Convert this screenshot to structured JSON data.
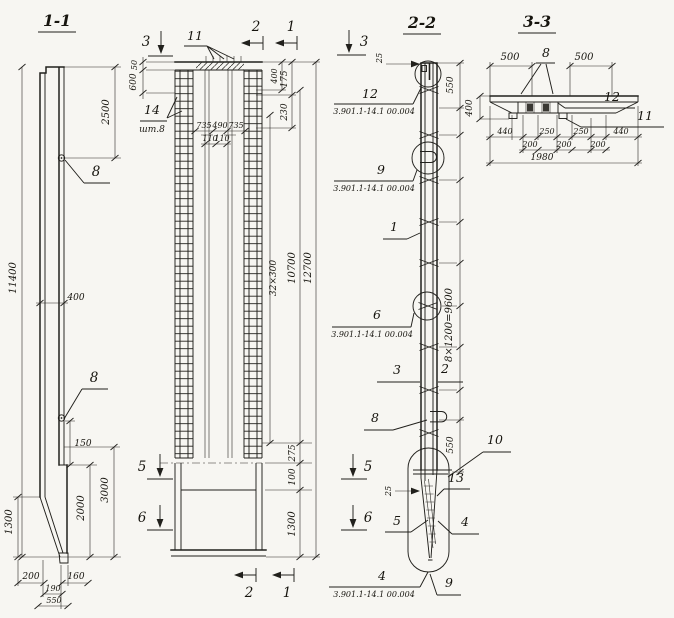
{
  "titles": {
    "s11": "1-1",
    "s22": "2-2",
    "s33": "3-3"
  },
  "v11": {
    "d11400": "11400",
    "d2500": "2500",
    "d400": "400",
    "d150": "150",
    "d3000": "3000",
    "d2000": "2000",
    "d1300": "1300",
    "d200": "200",
    "d160": "160",
    "d190": "190",
    "d550": "550",
    "c8_top": "8",
    "c8_bottom": "8"
  },
  "vm": {
    "m3": "3",
    "m2_top": "2",
    "m1_top": "1",
    "m5": "5",
    "m6": "6",
    "m2_bot": "2",
    "m1_bot": "1",
    "d50": "50",
    "d600": "600",
    "c11": "11",
    "c14": "14",
    "c14_qty": "шт.8",
    "d735a": "735",
    "d490": "490",
    "d735b": "735",
    "d110a": "110",
    "d110b": "110",
    "d400": "400",
    "d230": "230",
    "d175": "175",
    "d32x300": "32×300",
    "d10700": "10700",
    "d12700": "12700",
    "d275": "275",
    "d100": "100",
    "d1300": "1300"
  },
  "v22": {
    "m3": "3",
    "m5": "5",
    "m6": "6",
    "d25_top": "25",
    "d550_top": "550",
    "d8x1200": "8×1200=9600",
    "d550_bot": "550",
    "d25_bot": "25",
    "c12": "12",
    "c12_doc": "3.901.1-14.1 00.004",
    "c9": "9",
    "c9_doc": "3.901.1-14.1 00.004",
    "c1": "1",
    "c6": "6",
    "c6_doc": "3.901.1-14.1 00.004",
    "c3": "3",
    "c2": "2",
    "c8": "8",
    "c10": "10",
    "c13": "13",
    "c5": "5",
    "c4": "4",
    "c4b": "4",
    "c4b_doc": "3.901.1-14.1 00.004",
    "c9b": "9"
  },
  "v33": {
    "d500l": "500",
    "d500r": "500",
    "c8": "8",
    "c12": "12",
    "c11": "11",
    "d400": "400",
    "d440l": "440",
    "d250l": "250",
    "d250r": "250",
    "d440r": "440",
    "d200a": "200",
    "d200b": "200",
    "d200c": "200",
    "d1980": "1980"
  }
}
